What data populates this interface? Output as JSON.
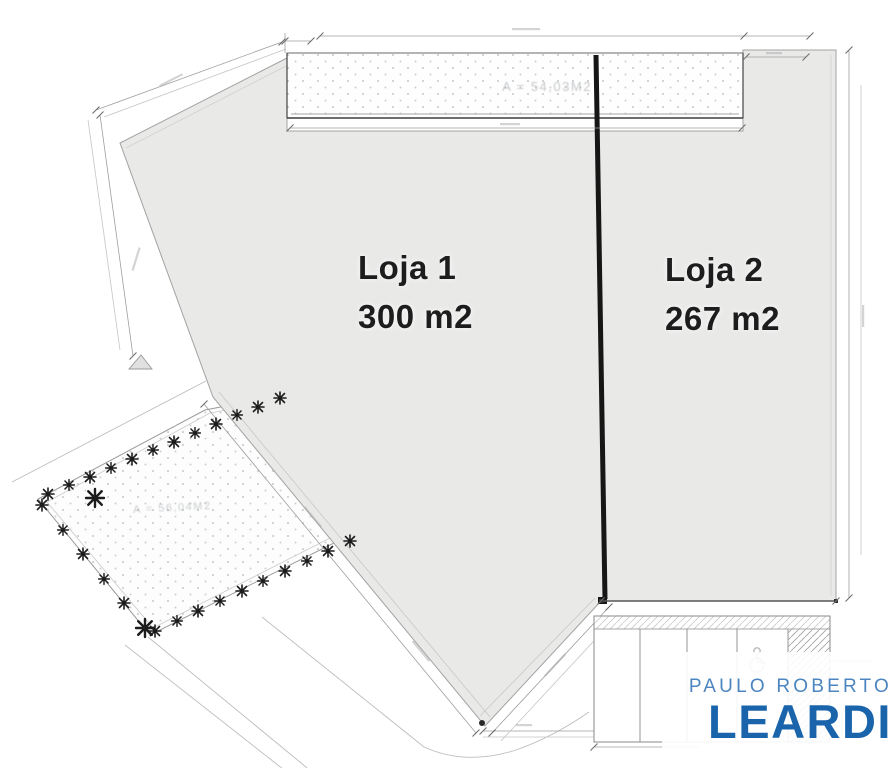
{
  "plan": {
    "loja1": {
      "name": "Loja 1",
      "area": "300 m2"
    },
    "loja2": {
      "name": "Loja 2",
      "area": "267 m2"
    },
    "strip_area_label": "A = 54,03M2",
    "garden_area_label": "A = 56,04M2",
    "colors": {
      "floor_fill": "#e9e9e8",
      "plan_line": "#9a9a9a",
      "divider_wall": "#161616",
      "hatch_dot": "#c6c6c6"
    },
    "icons": {
      "tree_icon": "plant asterisk ✳",
      "wheelchair_icon": "accessible stall ♿",
      "triangle_marker_icon": "▲"
    }
  },
  "logo": {
    "line1": "PAULO ROBERTO",
    "line2": "LEARDI",
    "line1_color": "#4c85c0",
    "line2_color": "#1a64ab"
  }
}
